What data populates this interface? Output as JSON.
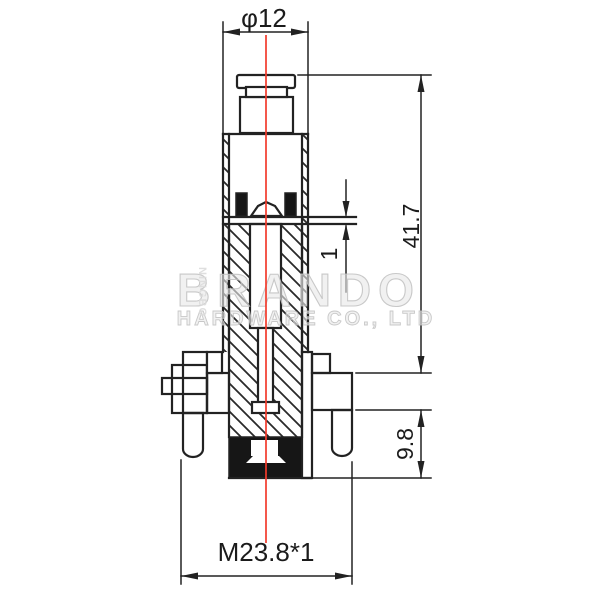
{
  "drawing": {
    "dimensions": {
      "top_diameter": "φ12",
      "overall_height": "41.7",
      "stroke_gap": "1",
      "lower_section_height": "9.8",
      "thread_spec": "M23.8*1"
    },
    "watermark": {
      "brand": "BRANDO",
      "subtitle": "HARDWARE CO., LTD",
      "side_text": "NINGBO"
    },
    "colors": {
      "line": "#222222",
      "centerline_red": "#f23b2c",
      "seal_black": "#161616",
      "watermark_gray": "#e9e9e9"
    }
  }
}
